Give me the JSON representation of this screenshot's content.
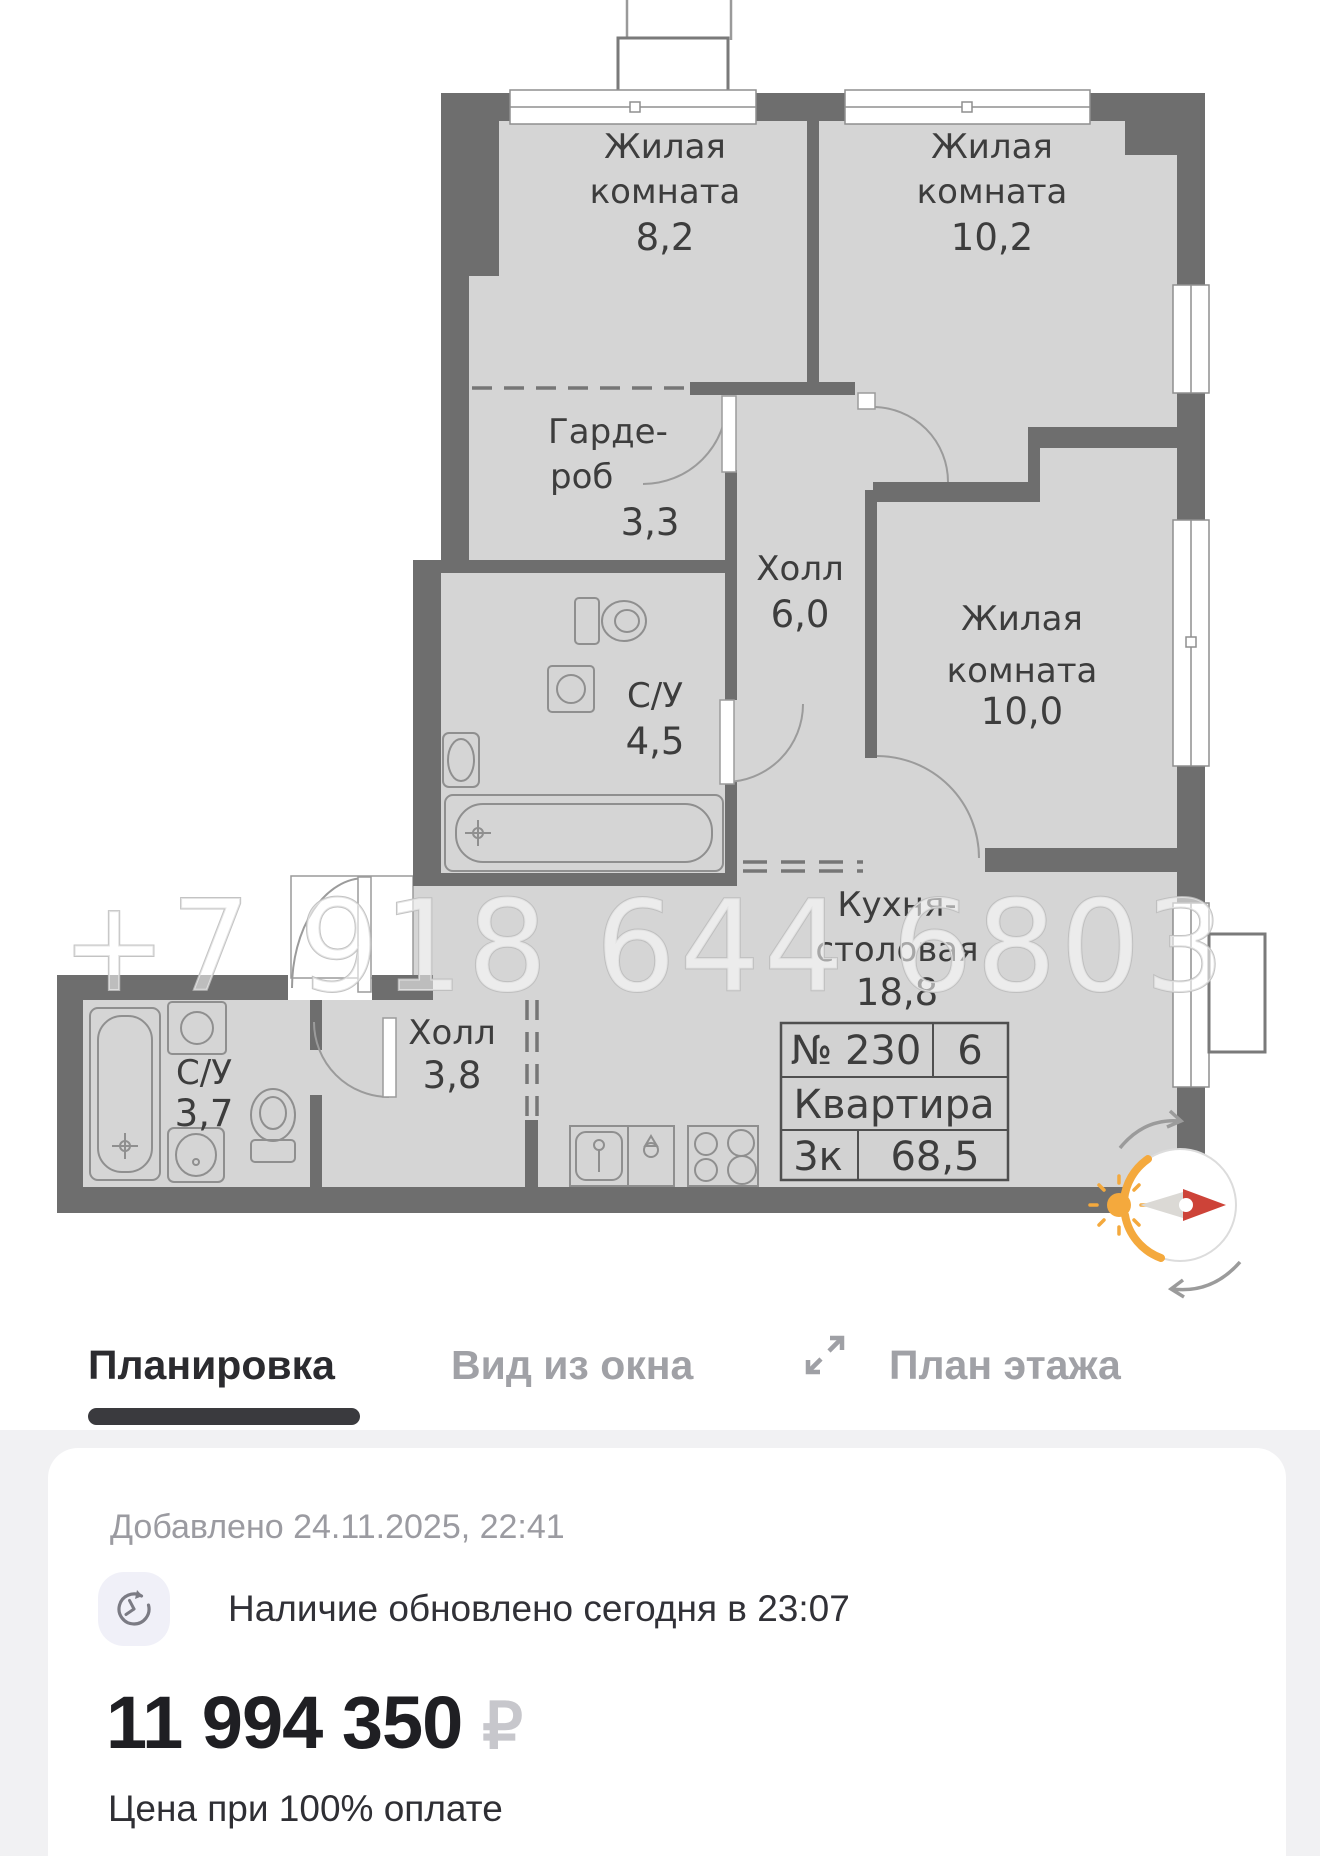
{
  "plan": {
    "watermark": "+7 918 644 6803",
    "room_82": {
      "n1": "Жилая",
      "n2": "комната",
      "area": "8,2"
    },
    "room_102": {
      "n1": "Жилая",
      "n2": "комната",
      "area": "10,2"
    },
    "wardrobe": {
      "n1": "Гарде-",
      "n2": "роб",
      "area": "3,3"
    },
    "hall_6": {
      "n1": "Холл",
      "area": "6,0"
    },
    "bath_45": {
      "n1": "С/У",
      "area": "4,5"
    },
    "room_100": {
      "n1": "Жилая",
      "n2": "комната",
      "area": "10,0"
    },
    "kitchen": {
      "n1": "Кухня-",
      "n2": "столовая",
      "area": "18,8"
    },
    "hall_38": {
      "n1": "Холл",
      "area": "3,8"
    },
    "bath_37": {
      "n1": "С/У",
      "area": "3,7"
    },
    "table": {
      "number": "№ 230",
      "floor": "6",
      "type": "Квартира",
      "rooms": "3к",
      "area": "68,5"
    }
  },
  "tabs": {
    "layout": "Планировка",
    "window_view": "Вид из окна",
    "floor_plan": "План этажа"
  },
  "details": {
    "added": "Добавлено 24.11.2025, 22:41",
    "availability": "Наличие обновлено сегодня в 23:07",
    "price": "11 994 350",
    "currency": "₽",
    "price_note": "Цена при 100% оплате"
  }
}
